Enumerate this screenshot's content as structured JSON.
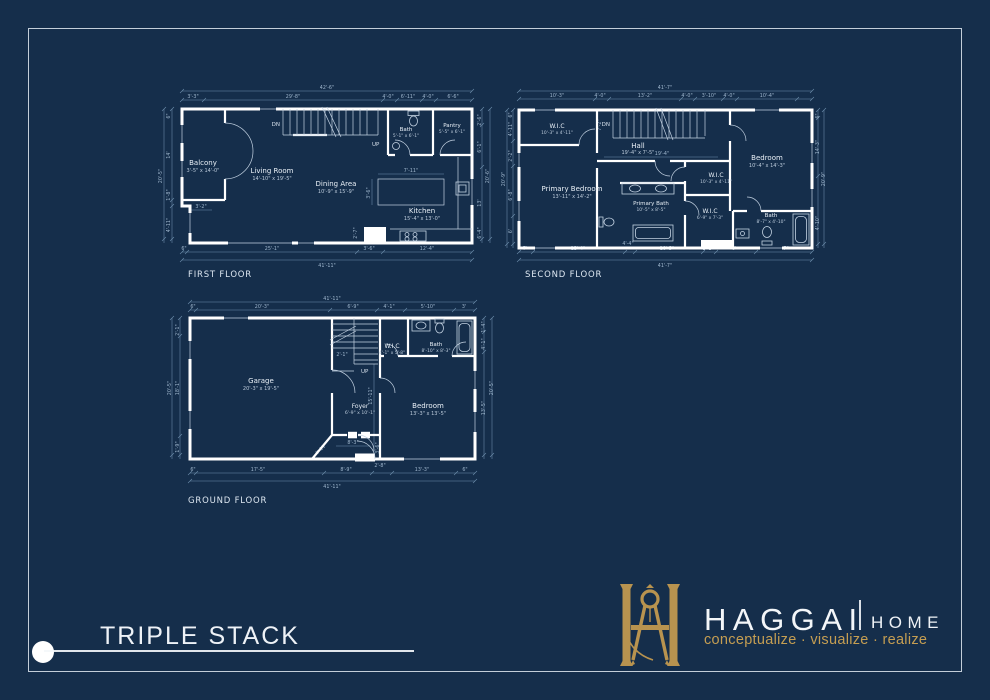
{
  "colors": {
    "background": "#152e4b",
    "gold": "#b8934f",
    "tagline_gold": "#c59e52",
    "wall_white": "#ffffff",
    "dim_blue": "#9fb6cd"
  },
  "title": {
    "text": "TRIPLE STACK"
  },
  "brand": {
    "name": "HAGGAI",
    "word2": "HOME",
    "tagline": "conceptualize · visualize · realize"
  },
  "f1": {
    "label": "FIRST FLOOR",
    "rooms": {
      "balcony": {
        "name": "Balcony",
        "size": "3'-5\" x 14'-0\""
      },
      "living": {
        "name": "Living Room",
        "size": "14'-10\" x 19'-5\""
      },
      "dining": {
        "name": "Dining Area",
        "size": "10'-9\" x 15'-9\""
      },
      "kitchen": {
        "name": "Kitchen",
        "size": "15'-4\" x 13'-0\""
      },
      "bath": {
        "name": "Bath",
        "size": "5'-1\" x 6'-1\""
      },
      "pantry": {
        "name": "Pantry",
        "size": "5'-5\" x 6'-1\""
      }
    },
    "stairs": {
      "dn": "DN",
      "up": "UP"
    },
    "dims": {
      "top_total": "42'-6\"",
      "top": [
        "3'-3\"",
        "29'-8\"",
        "4'-0\"",
        "6'-11\"",
        "4'-0\"",
        "6'-6\""
      ],
      "left": [
        "6\"",
        "14'",
        "20'-5\"",
        "1'-8\"",
        "4'-11\""
      ],
      "right": [
        "2'-6\"",
        "6'-1\"",
        "20'-6\"",
        "13'",
        "6'-4\""
      ],
      "bottom": [
        "6\"",
        "25'-1\"",
        "3'-6\"",
        "12'-4\""
      ],
      "bottom_total": "41'-11\"",
      "inner": [
        "7'-11\"",
        "3'-6\"",
        "3'-2\"",
        "2'-7\""
      ]
    }
  },
  "f2": {
    "label": "SECOND FLOOR",
    "rooms": {
      "wic1": {
        "name": "W.I.C",
        "size": "10'-3\" x 4'-11\""
      },
      "hall": {
        "name": "Hall",
        "size": "19'-4\" x 7'-5\""
      },
      "primary_bedroom": {
        "name": "Primary Bedroom",
        "size": "13'-11\" x 14'-2\""
      },
      "primary_bath": {
        "name": "Primary Bath",
        "size": "10'-5\" x 8'-5\""
      },
      "wic2": {
        "name": "W.I.C",
        "size": "10'-3\" x 4'-11\""
      },
      "wic3": {
        "name": "W.I.C",
        "size": "6'-9\" x 7'-3\""
      },
      "bedroom": {
        "name": "Bedroom",
        "size": "10'-4\" x 14'-3\""
      },
      "bath": {
        "name": "Bath",
        "size": "8'-7\" x 4'-10\""
      }
    },
    "stairs": {
      "dn": "DN"
    },
    "dims": {
      "top_total": "41'-7\"",
      "top": [
        "10'-3\"",
        "4'-0\"",
        "13'-2\"",
        "4'-0\"",
        "3'-10\"",
        "4'-0\"",
        "10'-4\""
      ],
      "left": [
        "6\"",
        "4'-11\"",
        "2'-2\"",
        "20'-9\"",
        "6'-8\"",
        "6'"
      ],
      "right": [
        "6\"",
        "14'-3\"",
        "20'-9\"",
        "4'-10\""
      ],
      "bottom": [
        "7'",
        "13'-4\"",
        "4'-4\"",
        "10'-5\"",
        "1'-1\"",
        "6'",
        "8'-7\""
      ],
      "bottom_total": "41'-7\"",
      "inner": [
        "19'-4\"",
        "7'-2\""
      ]
    }
  },
  "f3": {
    "label": "GROUND FLOOR",
    "rooms": {
      "garage": {
        "name": "Garage",
        "size": "20'-3\" x 19'-5\""
      },
      "foyer": {
        "name": "Foyer",
        "size": "6'-9\" x 10'-1\""
      },
      "bedroom": {
        "name": "Bedroom",
        "size": "13'-3\" x 13'-5\""
      },
      "wic": {
        "name": "W.I.C",
        "size": "4'-1\" x 5'-8\""
      },
      "bath": {
        "name": "Bath",
        "size": "8'-10\" x 8'-3\""
      }
    },
    "stairs": {
      "up": "UP"
    },
    "dims": {
      "top_total": "41'-11\"",
      "top": [
        "6\"",
        "20'-3\"",
        "6'-9\"",
        "4'-1\"",
        "5'-10\"",
        "3'"
      ],
      "left": [
        "2'-1\"",
        "18'-1\"",
        "1'-9\"",
        "20'-5\""
      ],
      "right": [
        "1'-4\"",
        "4'-1\"",
        "13'-5\"",
        "20'-5\""
      ],
      "bottom": [
        "6\"",
        "17'-5\"",
        "8'-9\"",
        "2'-8\"",
        "13'-3\"",
        "6\""
      ],
      "bottom_total": "41'-11\"",
      "inner": [
        "15'-11\"",
        "8'-3\"",
        "3'-6\"",
        "4'-11\"",
        "2'-1\""
      ]
    }
  }
}
